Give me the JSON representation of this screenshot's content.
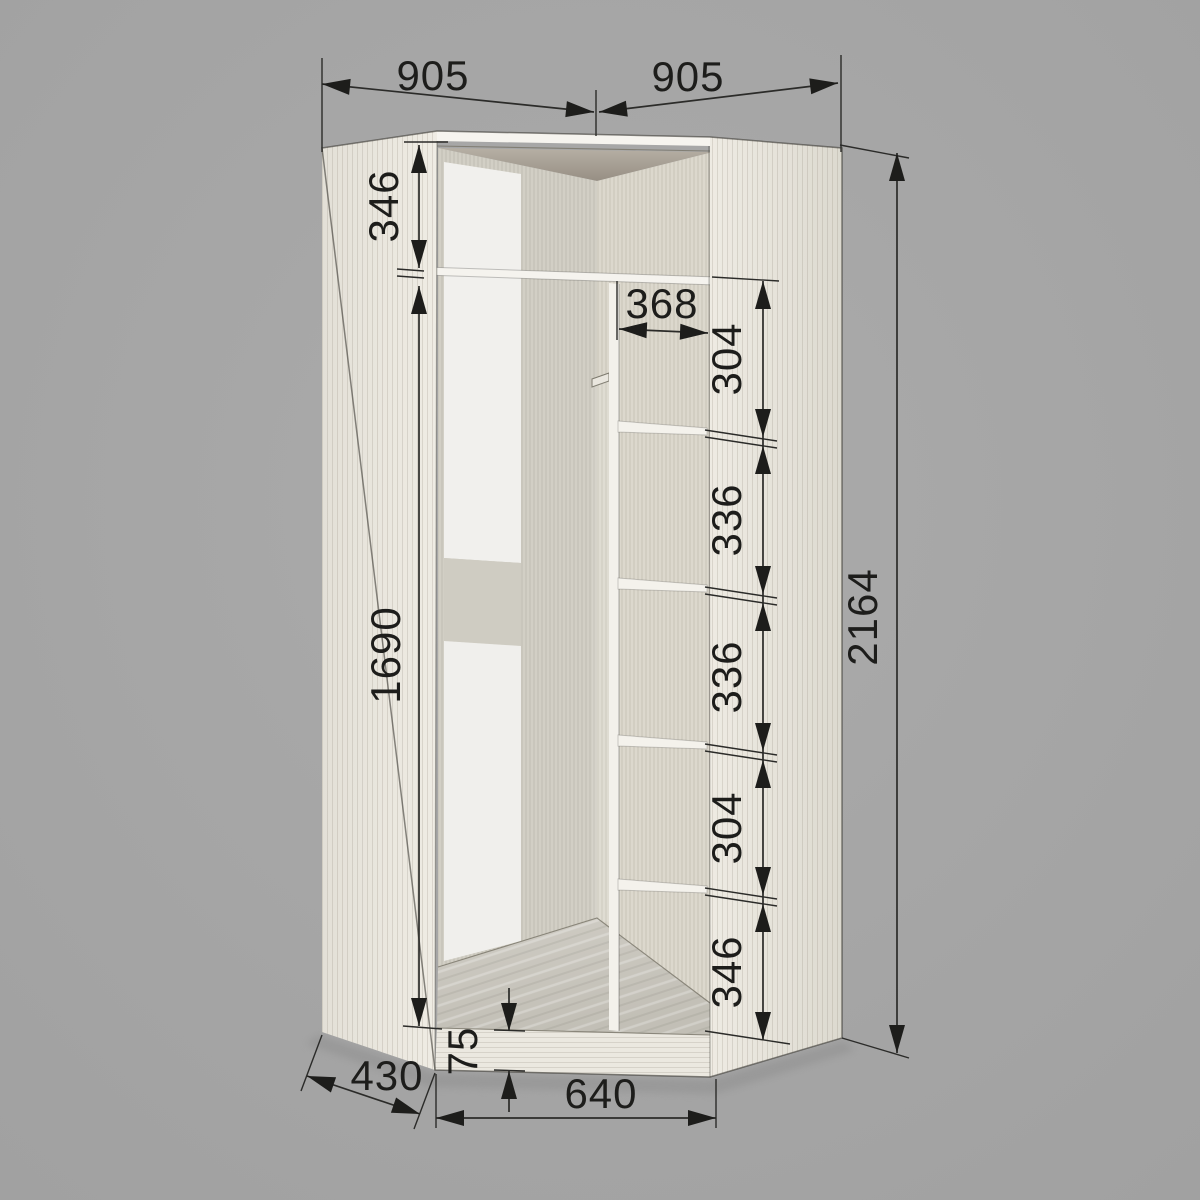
{
  "page": {
    "background": "#a7a7a7"
  },
  "drawing": {
    "object": "corner-wardrobe-cutaway-dimension-drawing",
    "units": "mm",
    "line_color": "#2b2b29",
    "text_color": "#1d1d1b",
    "panel_color": "#e9e6de",
    "dimensions": {
      "top_width_left": "905",
      "top_width_right": "905",
      "overall_height": "2164",
      "top_compartment_height": "346",
      "hanging_section_height": "1690",
      "shelf_column_width": "368",
      "shelf_gaps": [
        "304",
        "336",
        "336",
        "304",
        "346"
      ],
      "plinth_height": "75",
      "bottom_front_width": "640",
      "side_return_depth": "430"
    }
  }
}
